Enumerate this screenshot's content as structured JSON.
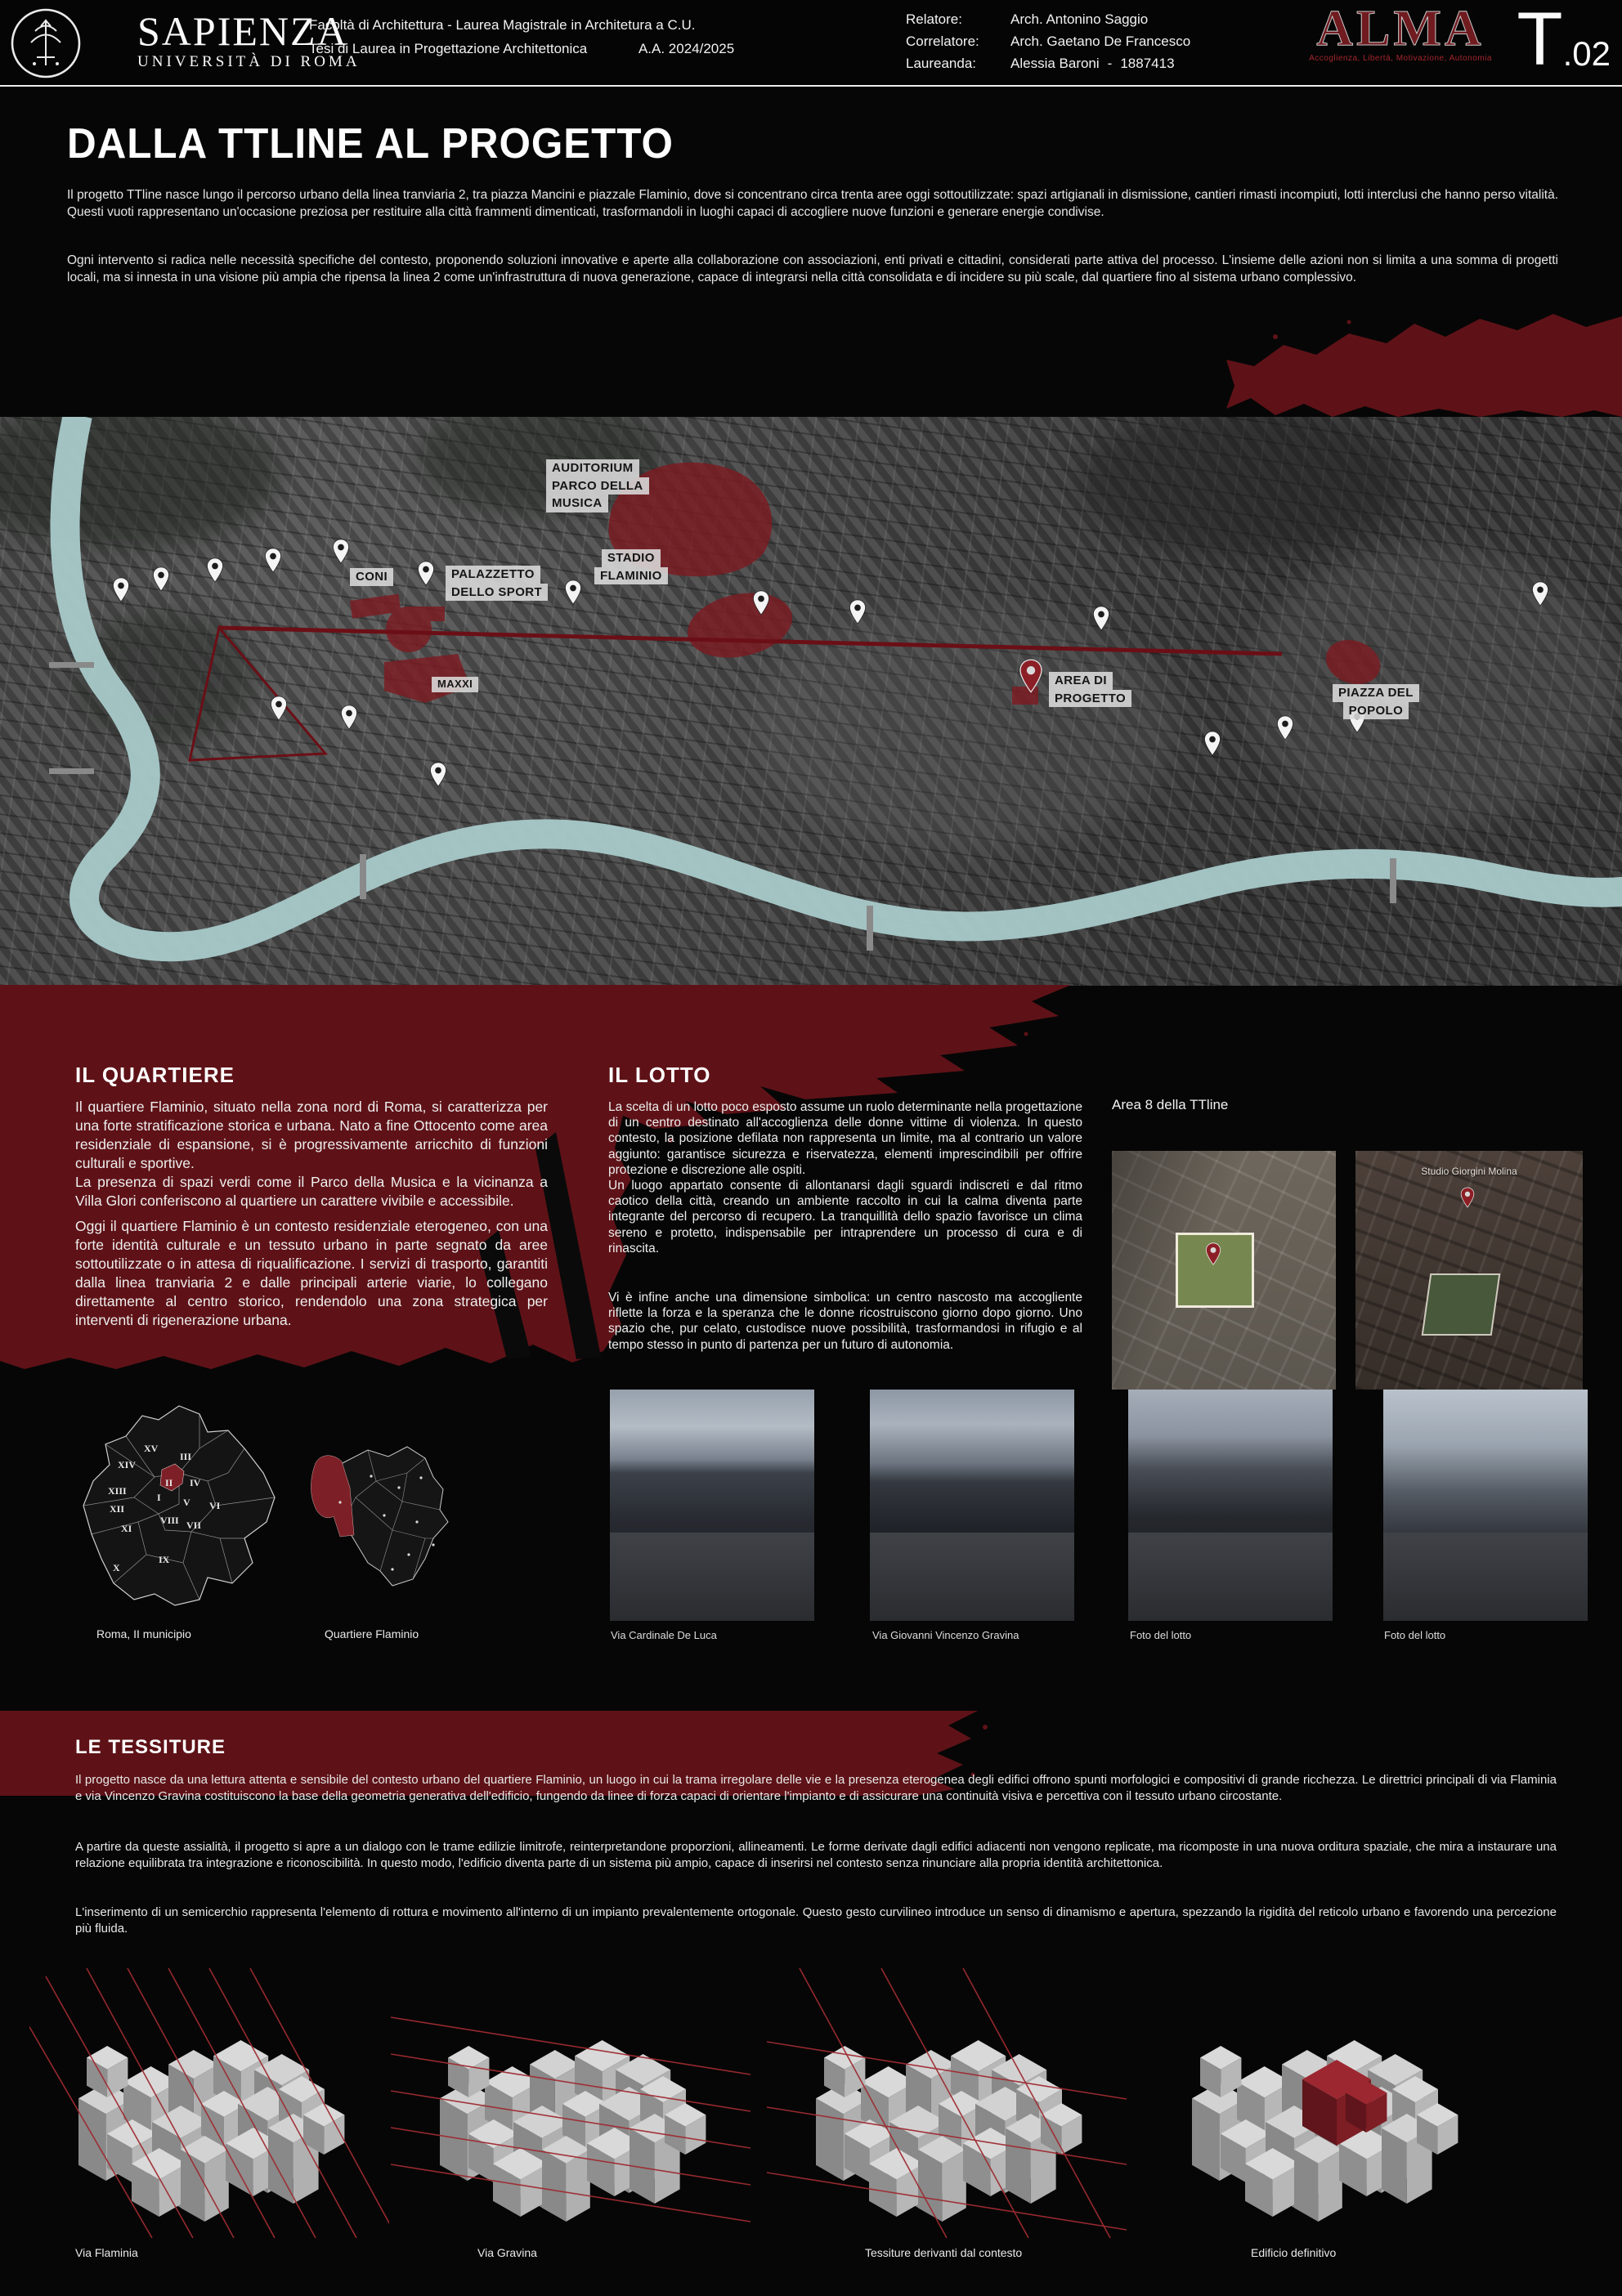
{
  "colors": {
    "accent_red": "#5e1217",
    "alma_red": "#701b20",
    "overlay_red": "#7c1b22",
    "river": "#a9caca"
  },
  "header": {
    "university": "SAPIENZA",
    "university_sub": "UNIVERSITÀ DI ROMA",
    "faculty_line1": "Facoltà di Architettura  -  Laurea Magistrale in Architetura a C.U.",
    "faculty_line2": "Tesi di Laurea in Progettazione Architettonica",
    "academic_year": "A.A. 2024/2025",
    "relatore_label": "Relatore:",
    "relatore": "Arch. Antonino Saggio",
    "correlatore_label": "Correlatore:",
    "correlatore": "Arch. Gaetano De Francesco",
    "laureanda_label": "Laureanda:",
    "laureanda": "Alessia Baroni",
    "matricola_sep": "-",
    "matricola": "1887413",
    "alma": "ALMA",
    "alma_subtitle": "Accoglienza, Libertà, Motivazione, Autonomia",
    "sheet_letter": "T",
    "sheet_number": ".02"
  },
  "intro": {
    "title": "DALLA TTLINE AL PROGETTO",
    "p1": "Il progetto TTline nasce lungo il percorso urbano della linea tranviaria 2, tra piazza Mancini e piazzale Flaminio, dove si concentrano circa trenta aree oggi sottoutilizzate: spazi artigianali in dismissione, cantieri rimasti incompiuti, lotti interclusi che hanno perso vitalità. Questi vuoti rappresentano un'occasione preziosa per restituire alla città frammenti dimenticati, trasformandoli in luoghi capaci di accogliere nuove funzioni e generare energie condivise.",
    "p2": "Ogni intervento si radica nelle necessità specifiche del contesto, proponendo soluzioni innovative e aperte alla collaborazione con associazioni, enti privati e cittadini, considerati parte attiva del processo. L'insieme delle azioni non si limita a una somma di progetti locali, ma si innesta in una visione più ampia che ripensa la linea 2 come un'infrastruttura di nuova generazione, capace di integrarsi nella città consolidata e di incidere su più scale, dal quartiere fino al sistema urbano complessivo."
  },
  "map": {
    "labels": {
      "auditorium": [
        "AUDITORIUM",
        "PARCO DELLA",
        "MUSICA"
      ],
      "coni": [
        "CONI"
      ],
      "palazzetto": [
        "PALAZZETTO",
        "DELLO SPORT"
      ],
      "stadio": [
        "STADIO",
        "FLAMINIO"
      ],
      "maxxi": [
        "MAXXI"
      ],
      "area": [
        "AREA DI",
        "PROGETTO"
      ],
      "popolo": [
        "PIAZZA DEL",
        "POPOLO"
      ]
    }
  },
  "quartiere": {
    "heading": "IL QUARTIERE",
    "p1": "Il quartiere Flaminio, situato nella zona nord di Roma, si caratterizza per una forte stratificazione storica e urbana. Nato a fine Ottocento come area residenziale di espansione, si è progressivamente arricchito di funzioni culturali e sportive.\nLa presenza di spazi verdi come il Parco della Musica e la vicinanza a Villa Glori conferiscono al quartiere un carattere vivibile e accessibile.",
    "p2": "Oggi il quartiere Flaminio è un contesto residenziale eterogeneo, con una forte identità culturale e un tessuto urbano in parte segnato da aree sottoutilizzate o in attesa di riqualificazione. I servizi di trasporto, garantiti dalla linea tranviaria 2 e dalle principali arterie viarie, lo collegano direttamente al centro storico, rendendolo una zona strategica per interventi di rigenerazione urbana."
  },
  "lotto": {
    "heading": "IL LOTTO",
    "p1": "La scelta di un lotto poco esposto assume un ruolo determinante nella progettazione di un centro destinato all'accoglienza delle donne vittime di violenza. In questo contesto, la posizione defilata non rappresenta un limite, ma al contrario un valore aggiunto: garantisce sicurezza e riservatezza, elementi imprescindibili per offrire protezione e discrezione alle ospiti.\nUn luogo appartato consente di allontanarsi dagli sguardi indiscreti e dal ritmo caotico della città, creando un ambiente raccolto in cui la calma diventa parte integrante del percorso di recupero. La tranquillità dello spazio favorisce un clima sereno e protetto, indispensabile per intraprendere un processo di cura e di rinascita.",
    "p2": "Vi è infine anche una dimensione simbolica: un centro nascosto ma accogliente riflette la forza e la speranza che le donne ricostruiscono giorno dopo giorno. Uno spazio che, pur celato, custodisce nuove possibilità, trasformandosi in rifugio e al tempo stesso in punto di partenza per un futuro di autonomia."
  },
  "area8": {
    "heading": "Area 8 della TTline",
    "map_label": "Studio Giorgini Molina"
  },
  "maps": {
    "roma_caption": "Roma, II municipio",
    "flaminio_caption": "Quartiere Flaminio",
    "municipi": [
      "XV",
      "III",
      "XIV",
      "IV",
      "II",
      "XIII",
      "I",
      "V",
      "VI",
      "XII",
      "VIII",
      "VII",
      "XI",
      "IX",
      "X"
    ]
  },
  "photos": [
    {
      "caption": "Via Cardinale De Luca"
    },
    {
      "caption": "Via Giovanni Vincenzo Gravina"
    },
    {
      "caption": "Foto del lotto"
    },
    {
      "caption": "Foto del lotto"
    }
  ],
  "tessiture": {
    "heading": "LE TESSITURE",
    "p1": "Il progetto nasce da una lettura attenta e sensibile del contesto urbano del quartiere Flaminio, un luogo in cui la trama irregolare delle vie e la presenza eterogenea degli edifici offrono spunti morfologici e compositivi di grande ricchezza. Le direttrici principali di via Flaminia e via Vincenzo Gravina costituiscono la base della geometria generativa dell'edificio, fungendo da linee di forza capaci di orientare l'impianto e di assicurare una continuità visiva e percettiva con il tessuto urbano circostante.",
    "p2": "A partire da queste assialità, il progetto si apre a un dialogo con le trame edilizie limitrofe, reinterpretandone proporzioni, allineamenti. Le forme derivate dagli edifici adiacenti non vengono replicate, ma ricomposte in una nuova orditura spaziale, che mira a instaurare una relazione equilibrata tra integrazione e riconoscibilità. In questo modo, l'edificio diventa parte di un sistema più ampio, capace di inserirsi nel contesto senza rinunciare alla propria identità architettonica.",
    "p3": "L'inserimento di un semicerchio rappresenta l'elemento di rottura e movimento all'interno di un impianto prevalentemente ortogonale. Questo gesto curvilineo introduce un senso di dinamismo e apertura, spezzando la rigidità del reticolo urbano e favorendo una percezione più fluida."
  },
  "diagrams": [
    {
      "caption": "Via Flaminia"
    },
    {
      "caption": "Via Gravina"
    },
    {
      "caption": "Tessiture derivanti dal contesto"
    },
    {
      "caption": "Edificio definitivo"
    }
  ]
}
